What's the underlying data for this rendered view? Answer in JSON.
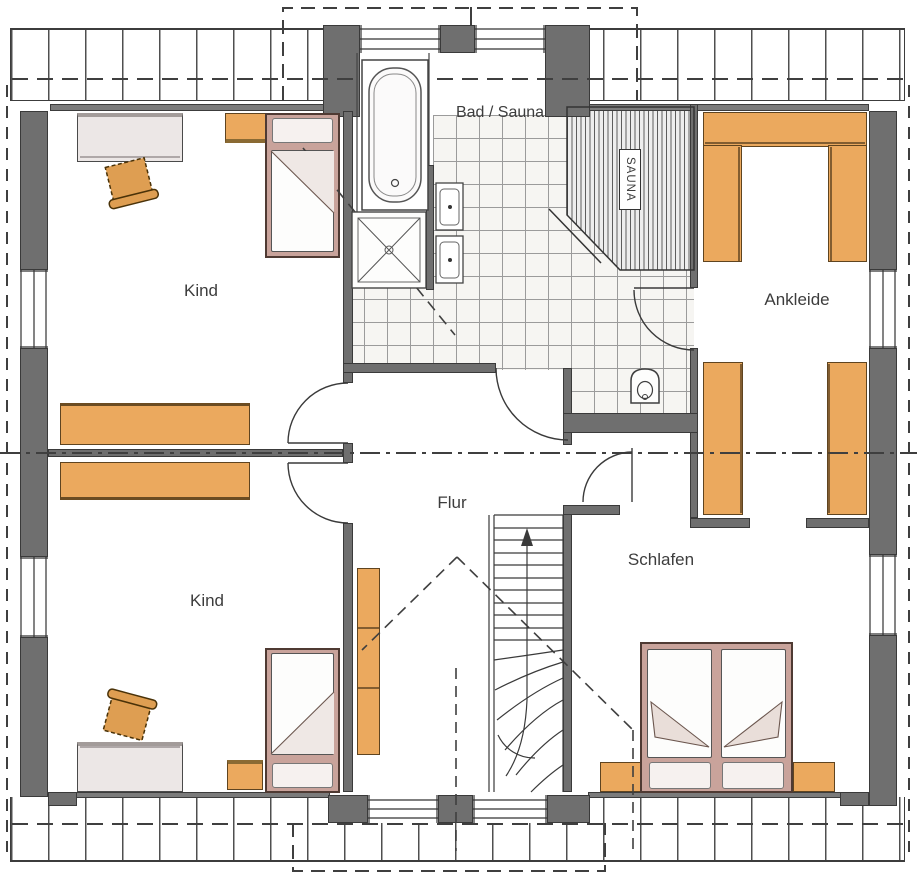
{
  "title": "Dachgeschoss Grundriss",
  "rooms": {
    "kind_top": {
      "label": "Kind"
    },
    "kind_bottom": {
      "label": "Kind"
    },
    "bad_sauna": {
      "label": "Bad / Sauna"
    },
    "sauna": {
      "label": "SAUNA"
    },
    "ankleide": {
      "label": "Ankleide"
    },
    "flur": {
      "label": "Flur"
    },
    "schlafen": {
      "label": "Schlafen"
    }
  },
  "colors": {
    "wall": "#6f6f6f",
    "line": "#3c3c3c",
    "furniture_wood": "#eba95e",
    "bed_frame": "#c9a39b",
    "tile_line": "#9b9b9b",
    "floor": "#ffffff"
  }
}
